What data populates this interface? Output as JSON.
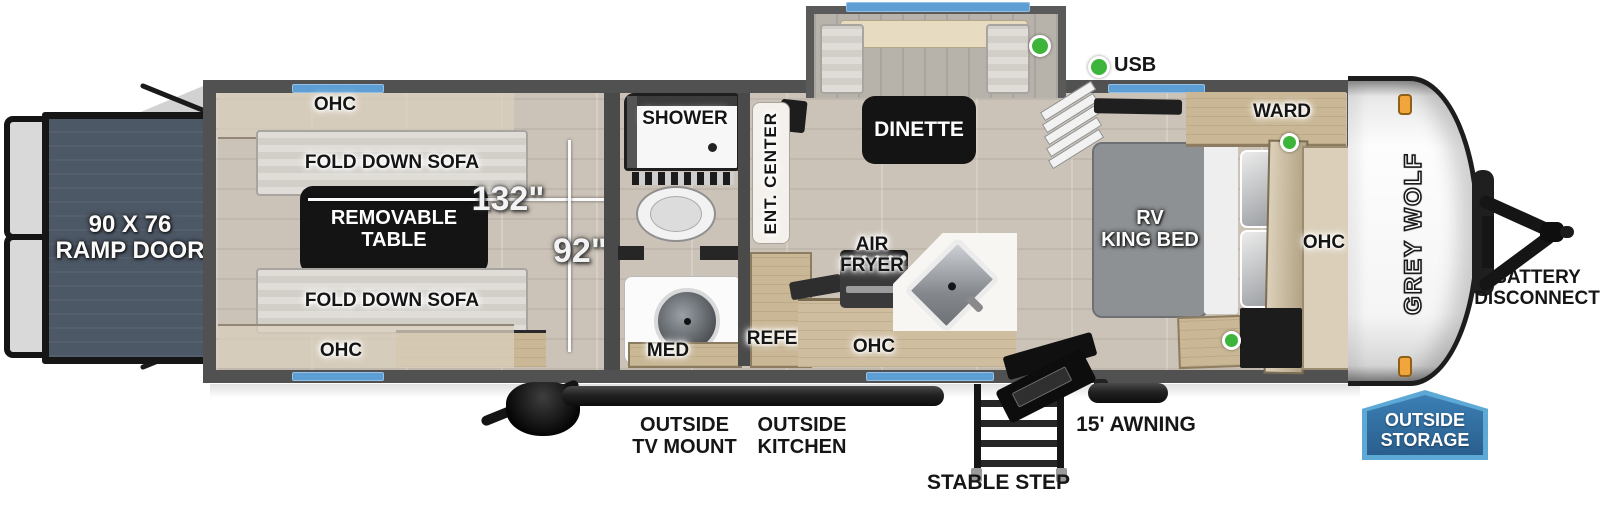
{
  "meta": {
    "title": "Grey Wolf travel trailer floorplan"
  },
  "colors": {
    "accent_blue": "#5d9fd4",
    "badge_fill": "#2f6b9e",
    "badge_border": "#5da9d6",
    "green_dot": "#3db53b",
    "orange_marker": "#f1a63c",
    "wall_gray": "#4a4a4a",
    "ramp_slate": "#4d5866"
  },
  "labels": {
    "ramp_door": "90 X 76\nRAMP DOOR",
    "ohc": "OHC",
    "fold_down_sofa": "FOLD DOWN SOFA",
    "removable_table": "REMOVABLE\nTABLE",
    "dim_width": "132\"",
    "dim_height": "92\"",
    "shower": "SHOWER",
    "med": "MED",
    "ent_center": "ENT. CENTER",
    "refer": "REFER",
    "dinette": "DINETTE",
    "usb": "USB",
    "air_fryer": "AIR\nFRYER",
    "rv_king_bed": "RV\nKING BED",
    "ward": "WARD",
    "battery_disconnect": "BATTERY\nDISCONNECT",
    "outside_tv_mount": "OUTSIDE\nTV MOUNT",
    "outside_kitchen": "OUTSIDE\nKITCHEN",
    "stable_step": "STABLE STEP",
    "awning": "15' AWNING",
    "outside_storage": "OUTSIDE\nSTORAGE",
    "brand": "GREY WOLF"
  }
}
